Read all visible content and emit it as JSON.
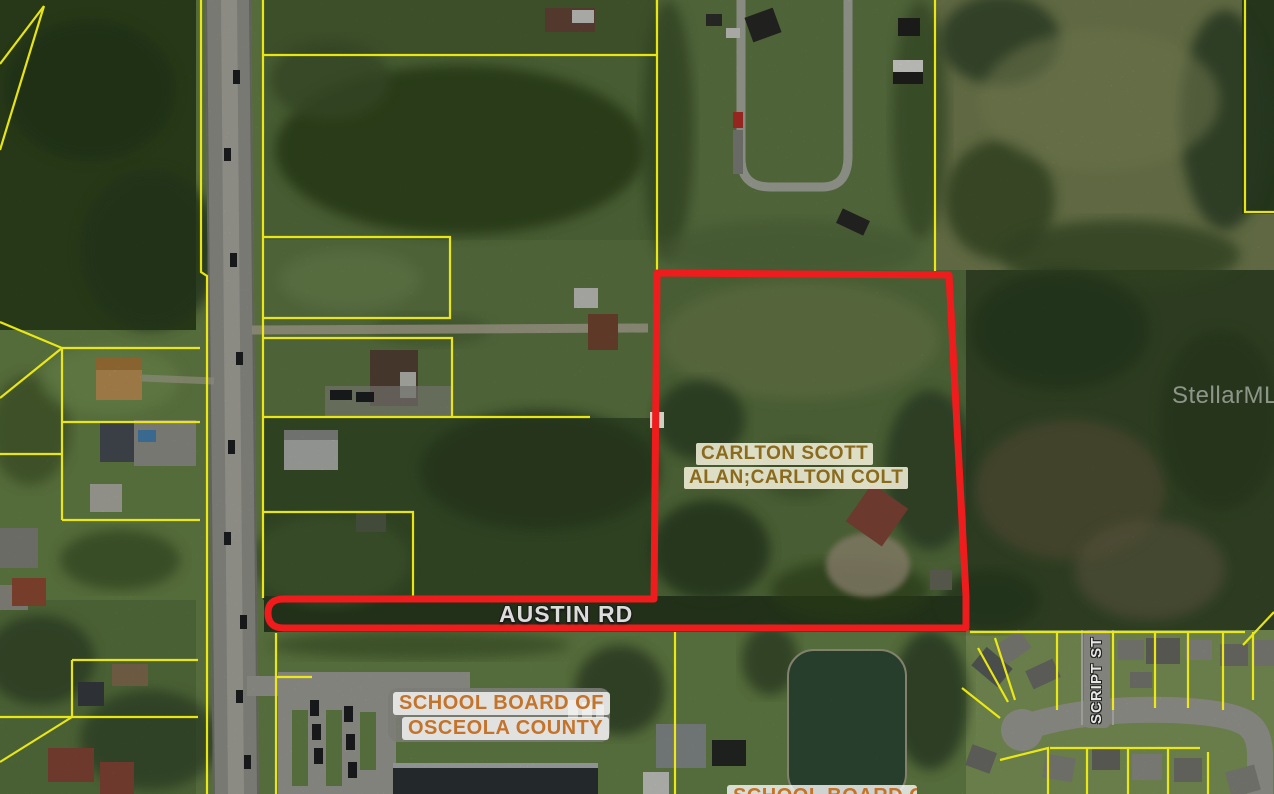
{
  "map": {
    "labels": {
      "owner_line1": "CARLTON SCOTT",
      "owner_line2": "ALAN;CARLTON COLT",
      "road": "AUSTIN RD",
      "street_vertical": "SCRIPT ST",
      "school_board_line1": "SCHOOL BOARD OF",
      "school_board_line2": "OSCEOLA COUNTY",
      "school_board_partial": "SCHOOL BOARD OF",
      "watermark": "StellarMLS"
    },
    "legend_colors": {
      "subject_boundary": "#ee1c1c",
      "parcel_lines": "#f2ee12",
      "owner_label_text": "#8a6a1d",
      "school_label_text": "#c4732b",
      "road_label_text": "#dcdcda"
    }
  }
}
